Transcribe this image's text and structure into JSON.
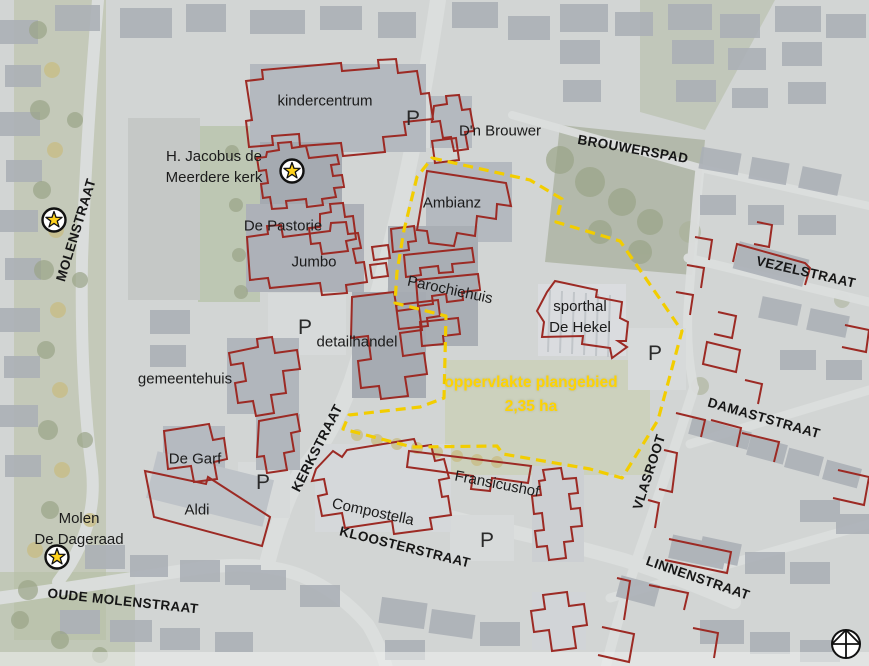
{
  "map": {
    "type": "aerial-photo-plan-map",
    "plan_area_outline": "plangebied boundary (dashed)"
  },
  "buildings": {
    "kindercentrum": "kindercentrum",
    "dn_brouwer": "D'n Brouwer",
    "kerk_line1": "H. Jacobus de",
    "kerk_line2": "Meerdere kerk",
    "ambianz": "Ambianz",
    "de_pastorie": "De Pastorie",
    "jumbo": "Jumbo",
    "parochiehuis": "Parochiehuis",
    "sporthal_line1": "sporthal",
    "sporthal_line2": "De Hekel",
    "detailhandel": "detailhandel",
    "gemeentehuis": "gemeentehuis",
    "de_garf": "De Garf",
    "aldi": "Aldi",
    "fransicushof": "Fransicushof",
    "compostella": "Compostella",
    "molen_line1": "Molen",
    "molen_line2": "De Dageraad"
  },
  "streets": {
    "molenstraat": "MOLENSTRAAT",
    "brouwerspad": "BROUWERSPAD",
    "vezelstraat": "VEZELSTRAAT",
    "damaststraat": "DAMASTSTRAAT",
    "kerkstraat": "KERKSTRAAT",
    "vlasroot": "VLASROOT",
    "kloosterstraat": "KLOOSTERSTRAAT",
    "linnenstraat": "LINNENSTRAAT",
    "oude_molenstraat": "OUDE MOLENSTRAAT"
  },
  "annotations": {
    "parking": "P",
    "area_line1": "oppervlakte plangebied",
    "area_line2": "2,35 ha"
  },
  "colors": {
    "building_outline_red": "#9c2a24",
    "plan_boundary_yellow": "#f2cd00",
    "area_text_yellow": "#fdd304",
    "label_text": "#1b1b1b"
  },
  "icons": {
    "star": "monument-star-icon",
    "compass": "north-compass-icon"
  }
}
